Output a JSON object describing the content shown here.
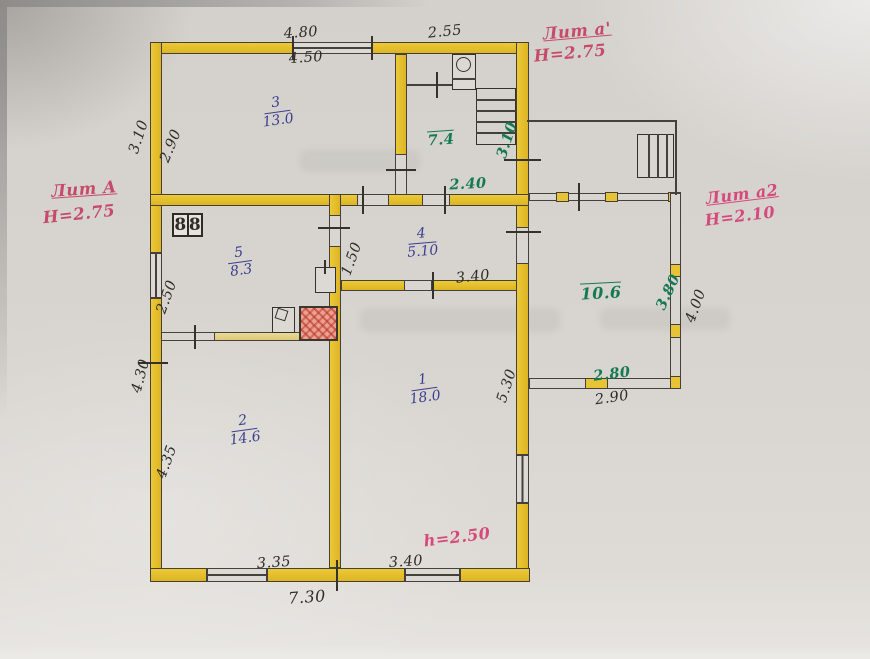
{
  "litera": {
    "main": {
      "label": "Лит А",
      "height": "Н=2.75"
    },
    "annex": {
      "label": "Лит а'",
      "height": "Н=2.75"
    },
    "veranda": {
      "label": "Лит а2",
      "height": "Н=2.10"
    }
  },
  "note_height": "h=2.50",
  "rooms": {
    "r3": {
      "num": "3",
      "area": "13.0"
    },
    "r5": {
      "num": "5",
      "area": "8.3"
    },
    "r4": {
      "num": "4",
      "area": "5.10"
    },
    "r1": {
      "num": "1",
      "area": "18.0"
    },
    "r2": {
      "num": "2",
      "area": "14.6"
    },
    "annex_area": "7.4",
    "veranda_area": "10.6"
  },
  "dims": {
    "top_out": "4.80",
    "top_in": "4.50",
    "annex_top": "2.55",
    "left3_out": "3.10",
    "left3_in": "2.90",
    "left5": "2.50",
    "r4_h": "1.50",
    "r4_w": "3.40",
    "hall": "2.40",
    "annex_side": "3.10",
    "r1_h": "5.30",
    "ver_in_h": "3.80",
    "ver_out_h": "4.00",
    "ver_in_w": "2.80",
    "ver_out_w": "2.90",
    "left2_out": "4.30",
    "left2_in": "4.35",
    "bot2": "3.35",
    "bot1": "3.40",
    "bot_total": "7.30"
  },
  "symbols": {
    "stove_left": "8",
    "stove_right": "8"
  },
  "colors": {
    "wall": "#e8c532",
    "ink": "#2e2c28",
    "green": "#157a52",
    "blue": "#3c3e8f",
    "red": "#c64a6b",
    "pink": "#d5497d",
    "stove_red": "#dd6a5a"
  }
}
